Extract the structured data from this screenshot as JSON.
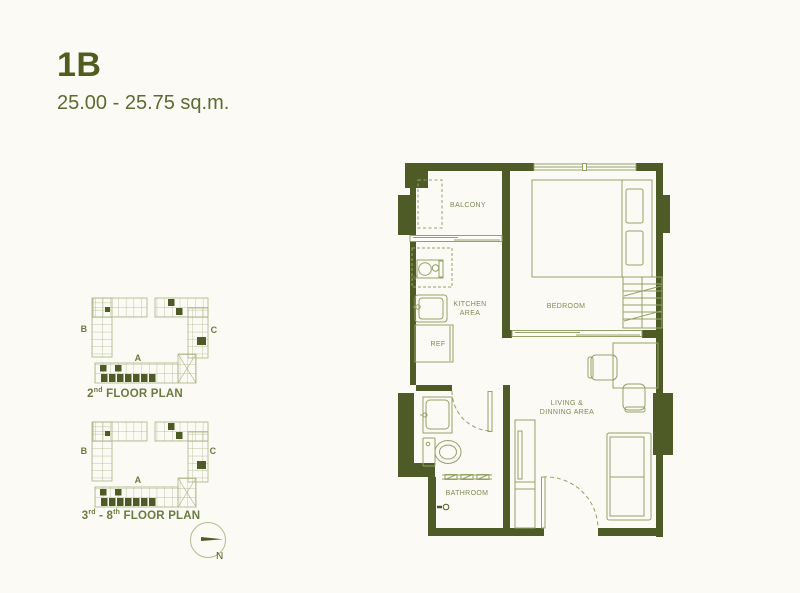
{
  "header": {
    "title": "1B",
    "subtitle": "25.00 - 25.75 sq.m."
  },
  "keyplans": {
    "plan1": {
      "wing_b": "B",
      "wing_c": "C",
      "wing_a": "A",
      "caption": {
        "p1": "2",
        "s1": "nd",
        "p2": "",
        "s2": "",
        "rest": " FLOOR PLAN"
      }
    },
    "plan2": {
      "wing_b": "B",
      "wing_c": "C",
      "wing_a": "A",
      "caption": {
        "p1": "3",
        "s1": "rd",
        "p2": " - 8",
        "s2": "th",
        "rest": " FLOOR PLAN"
      }
    }
  },
  "compass": {
    "north_label": "N"
  },
  "floorplan": {
    "labels": {
      "balcony": "BALCONY",
      "kitchen_line1": "KITCHEN",
      "kitchen_line2": "AREA",
      "washer": "W",
      "ref": "REF",
      "bedroom": "BEDROOM",
      "living_line1": "LIVING &",
      "living_line2": "DINNING AREA",
      "bathroom": "BATHROOM"
    }
  },
  "colors": {
    "wall": "#4f5b26",
    "furniture_line": "#94a168",
    "keyplan_line": "#aab384",
    "label_text": "#7e8a54",
    "title_text": "#515d1f",
    "background": "#fbfaf4"
  }
}
